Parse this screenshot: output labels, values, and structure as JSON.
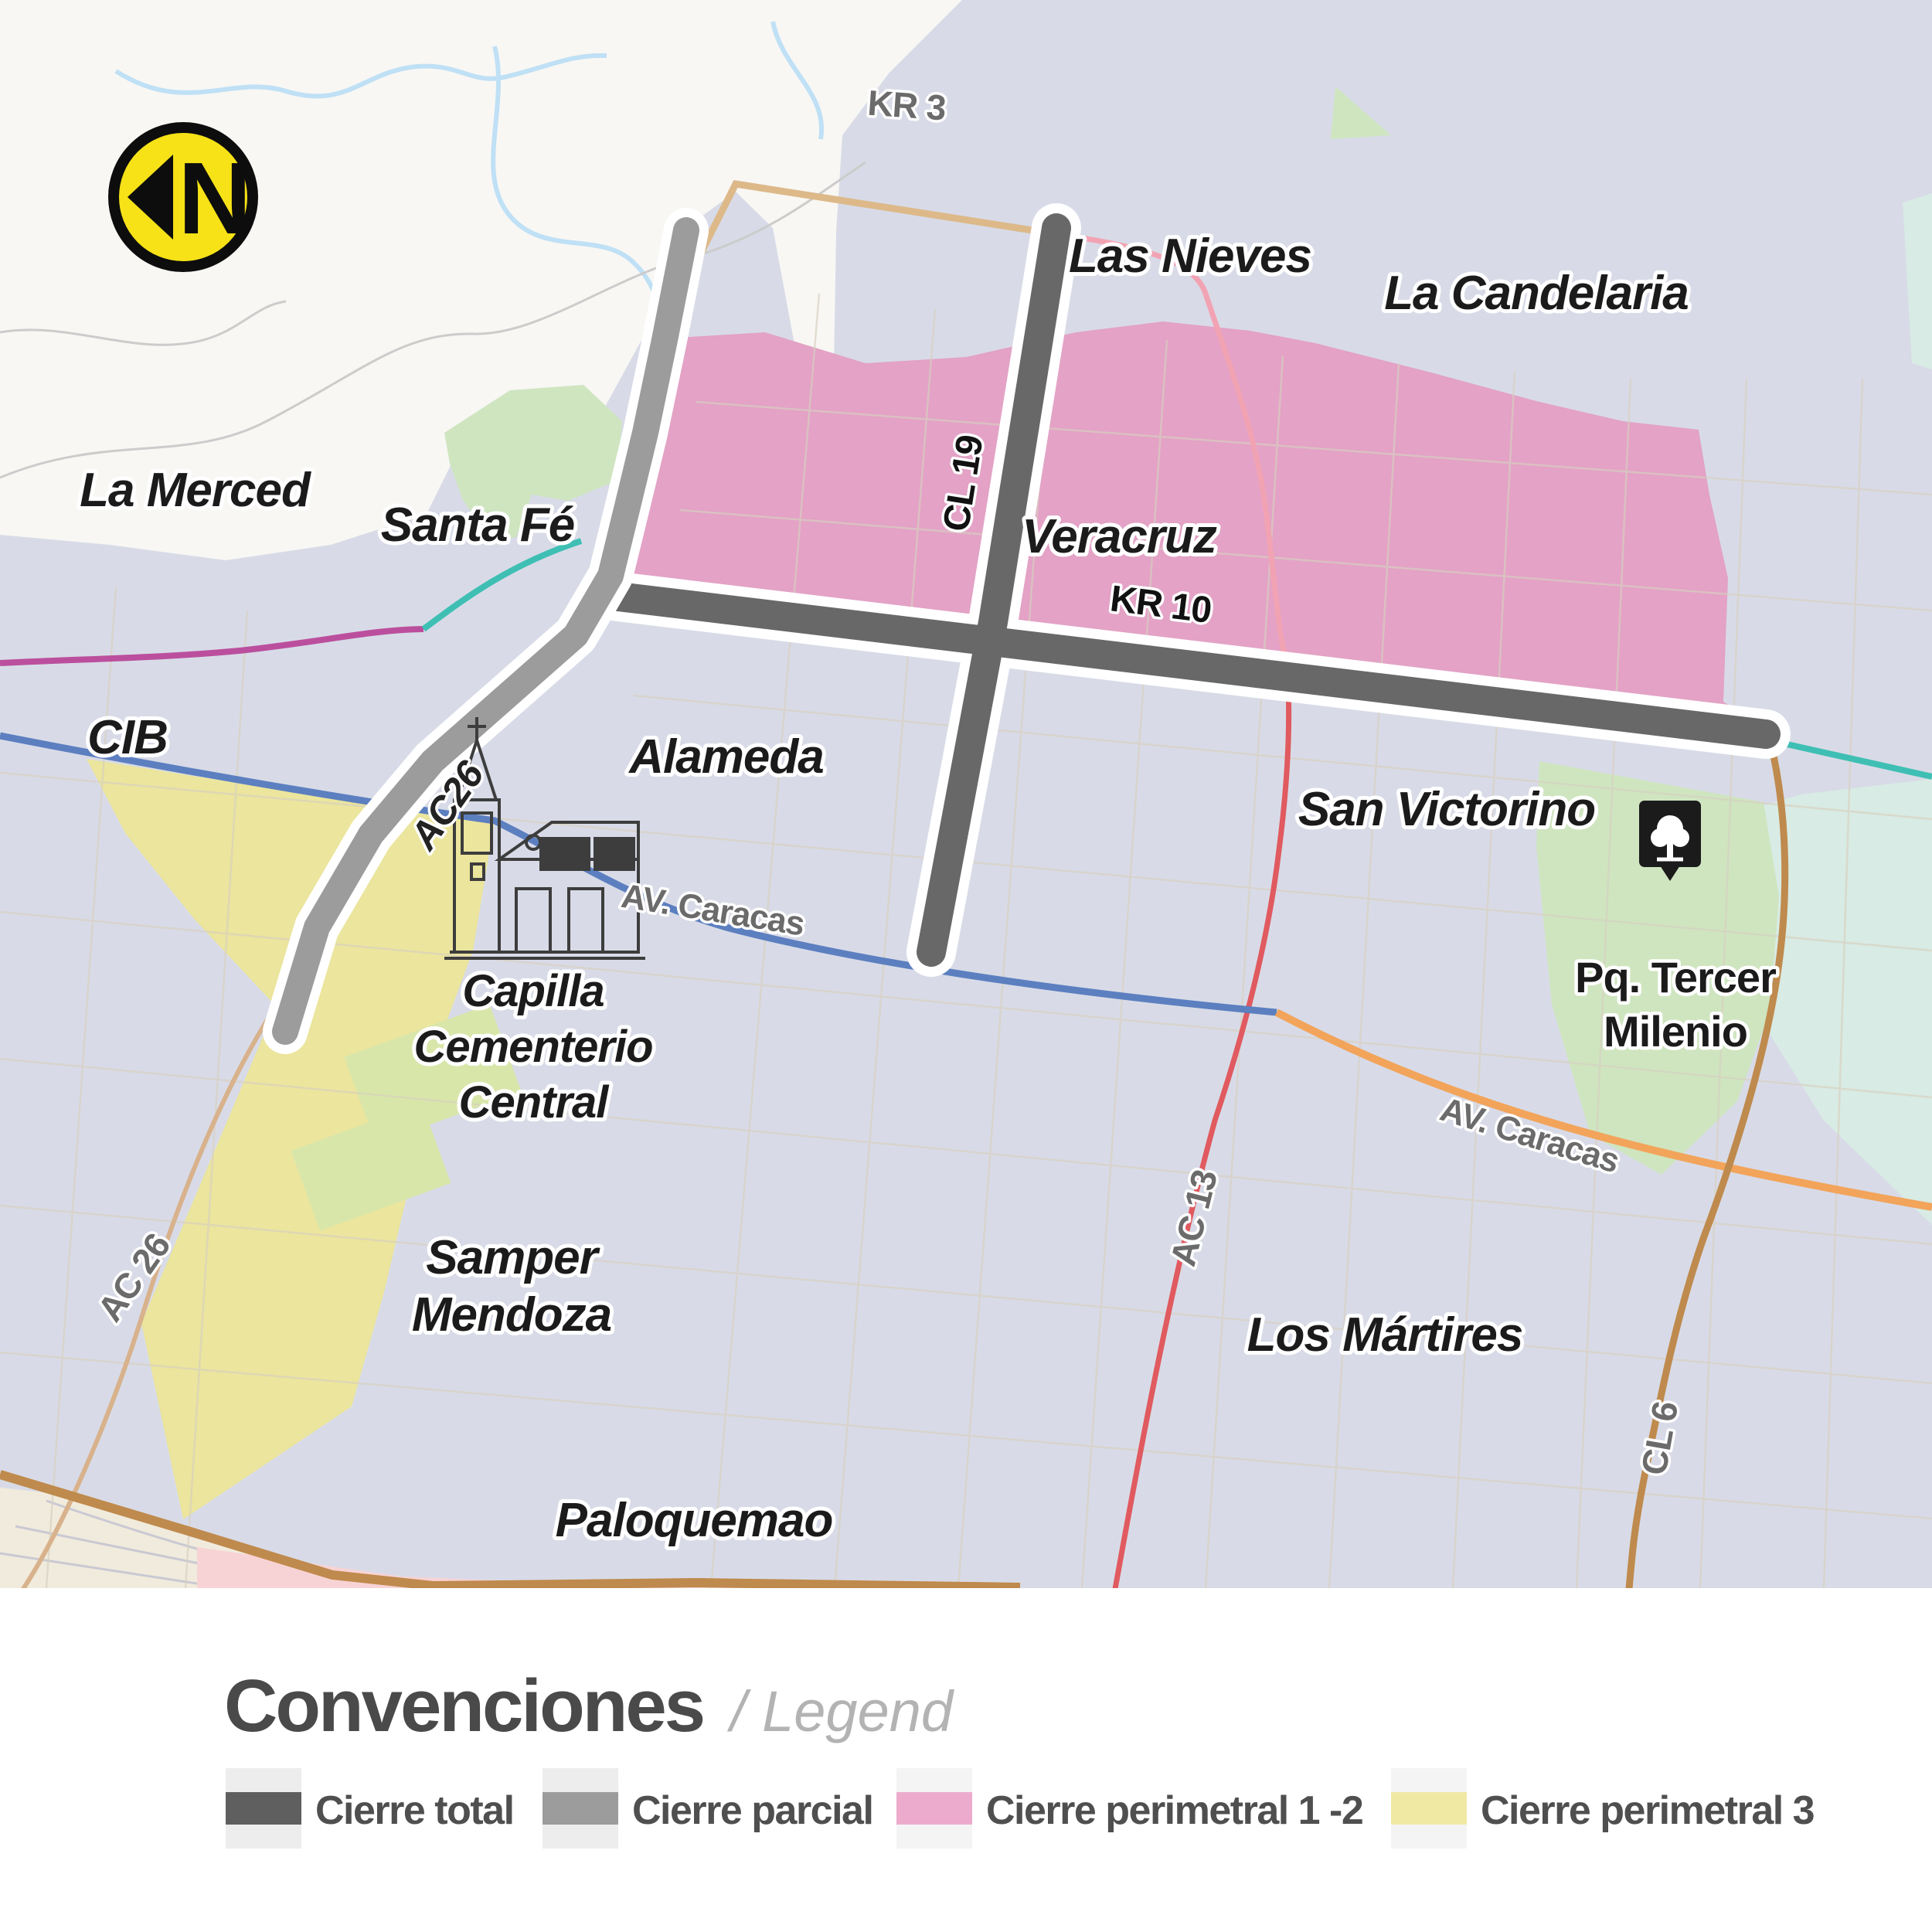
{
  "map": {
    "north_letter": "N",
    "labels": {
      "la_merced": "La Merced",
      "santa_fe": "Santa Fé",
      "cib": "CIB",
      "alameda": "Alameda",
      "las_nieves": "Las Nieves",
      "la_candelaria": "La Candelaria",
      "veracruz": "Veracruz",
      "san_victorino": "San Victorino",
      "samper_mendoza": [
        "Samper",
        "Mendoza"
      ],
      "los_martires": "Los Mártires",
      "paloquemao": "Paloquemao",
      "capilla": [
        "Capilla",
        "Cementerio",
        "Central"
      ],
      "pq_tercer_milenio": [
        "Pq. Tercer",
        "Milenio"
      ]
    },
    "roads": {
      "kr3": "KR 3",
      "cl19": "CL 19",
      "kr10": "KR 10",
      "ac26_upper": "AC26",
      "ac26_lower": "AC 26",
      "av_caracas_west": "AV. Caracas",
      "av_caracas_east": "AV. Caracas",
      "ac13": "AC 13",
      "cl6": "CL 6"
    },
    "colors": {
      "urban_bg": "#d8dbe7",
      "outside_bg": "#f8f7f4",
      "river_blue": "#bfe0f5",
      "contour_gray": "#cccccc",
      "perimetral12_pink": "#e3a2c6",
      "perimetral3_yellow": "#ebe59d",
      "park_green": "#cfe5c0",
      "cemetery_green": "#d9e6aa",
      "mint": "#d8ebe4",
      "cream": "#f1ebdd",
      "soft_pink": "#f8d3d5",
      "total_closure_dark": "#686868",
      "partial_closure_gray": "#9c9c9c",
      "casing_white": "#ffffff",
      "kr3_tan": "#ddb98a",
      "caracas_blue": "#5c7fc0",
      "caracas_orange": "#f2a45b",
      "cl6_brown": "#bf8a4d",
      "ac26_thin_brown": "#d8b28c",
      "teal_line": "#3fbfb4",
      "magenta_line": "#bb4f9e",
      "ac13_red": "#e05a5f",
      "ac13_pink": "#f2a3b3",
      "north_badge_yellow": "#f6e217",
      "label_gray": "#6b6b6b"
    }
  },
  "legend": {
    "title": "Convenciones",
    "subtitle": "/ Legend",
    "items": [
      {
        "label": "Cierre total",
        "color": "#5f5f5f"
      },
      {
        "label": "Cierre parcial",
        "color": "#9c9c9c"
      },
      {
        "label": "Cierre perimetral 1 -2",
        "color": "#ecabcd"
      },
      {
        "label": "Cierre perimetral 3",
        "color": "#f0e9a4"
      }
    ]
  }
}
